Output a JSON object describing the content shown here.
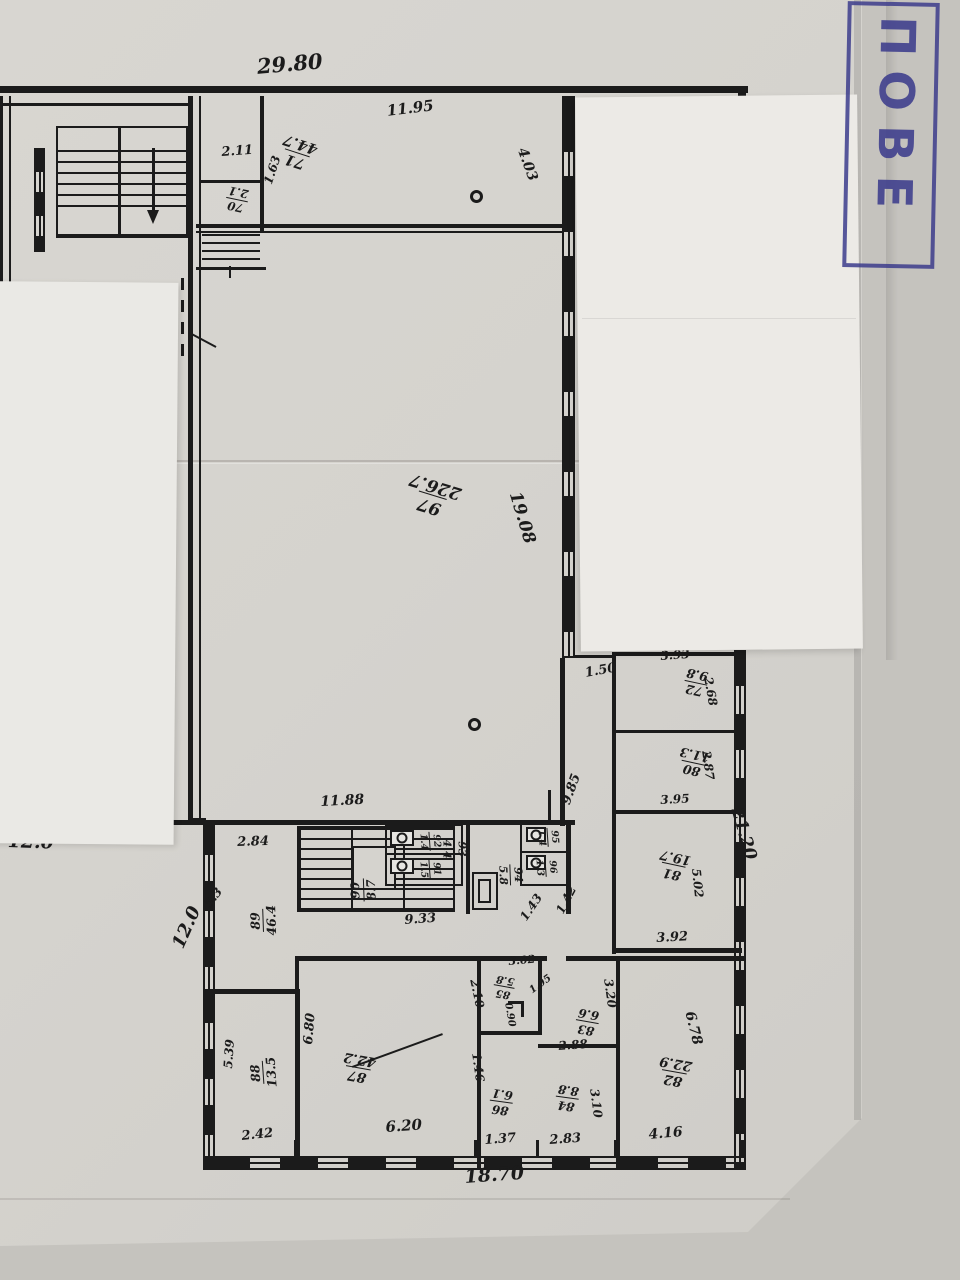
{
  "stamp": {
    "text": "ПОВЕ",
    "color": "#3c3c8c"
  },
  "rooms": {
    "r70": {
      "num": "70",
      "area": "2.1"
    },
    "r71": {
      "num": "71",
      "area": "44.7"
    },
    "r72": {
      "num": "72",
      "area": "9.8"
    },
    "r80": {
      "num": "80",
      "area": "11.3"
    },
    "r81": {
      "num": "81",
      "area": "19.7"
    },
    "r82": {
      "num": "82",
      "area": "22.9"
    },
    "r83": {
      "num": "83",
      "area": "6.6"
    },
    "r84": {
      "num": "84",
      "area": "8.8"
    },
    "r85": {
      "num": "85",
      "area": "5.8"
    },
    "r86": {
      "num": "86",
      "area": "6.1"
    },
    "r87": {
      "num": "87",
      "area": "42.2"
    },
    "r88": {
      "num": "88",
      "area": "13.5"
    },
    "r89": {
      "num": "89",
      "area": "46.4"
    },
    "r90": {
      "num": "90",
      "area": "8.7"
    },
    "r91": {
      "num": "91",
      "area": "1.5"
    },
    "r92": {
      "num": "92",
      "area": "1.4"
    },
    "r93": {
      "num": "93",
      "area": "4.4"
    },
    "r94": {
      "num": "94",
      "area": "5.8"
    },
    "r95": {
      "num": "95",
      "area": "1.4"
    },
    "r96": {
      "num": "96",
      "area": "1.3"
    },
    "r97": {
      "num": "97",
      "area": "226.7"
    }
  },
  "dims": {
    "top_width": "29.80",
    "w1195": "11.95",
    "w211": "2.11",
    "d163": "1.63",
    "h403": "4.03",
    "h1908": "19.08",
    "w1188": "11.88",
    "w284": "2.84",
    "d985": "9.85",
    "w933": "9.33",
    "d143": "1.43",
    "d142": "1.42",
    "d53": "5.3",
    "w393": "3.93",
    "h268": "2.68",
    "d150": "1.50",
    "h287": "2.87",
    "w395": "3.95",
    "h502": "5.02",
    "w392": "3.92",
    "right_height": "21.20",
    "h539": "5.39",
    "h680": "6.80",
    "w242": "2.42",
    "w620": "6.20",
    "h210": "2.10",
    "w302": "3.02",
    "d105": "1.05",
    "h090": "0.90",
    "h146": "1.46",
    "w137": "1.37",
    "h320": "3.20",
    "w288": "2.88",
    "h310": "3.10",
    "w283": "2.83",
    "h678": "6.78",
    "w416": "4.16",
    "bottom_width": "18.70"
  },
  "notes": {
    "n12a": "12.0",
    "n12b": "12.0"
  }
}
